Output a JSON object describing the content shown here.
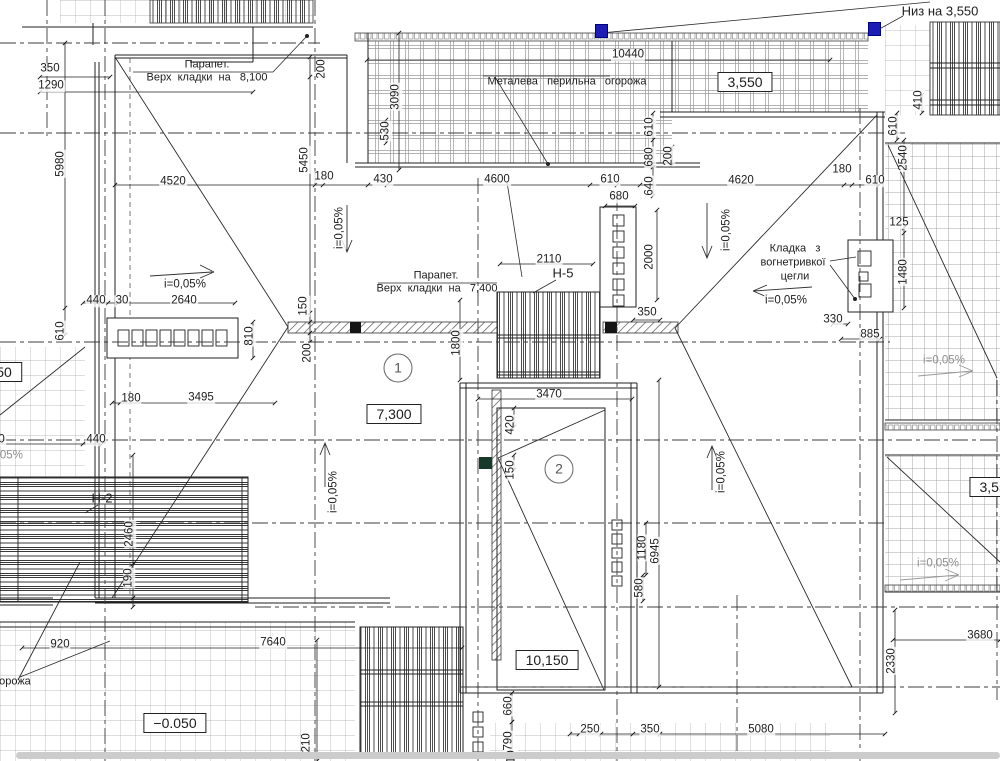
{
  "colors": {
    "paper": "#ffffff",
    "ink": "#1c1c1c",
    "grid": "#a0a0a0",
    "accent_blue": "#1d1db5",
    "muted": "#8f8f8f"
  },
  "plan": {
    "region_markers": [
      "1",
      "2"
    ],
    "node_labels": [
      "Н-5",
      "Н-2"
    ],
    "elevation_boxes": [
      "3,550",
      "7,300",
      "10,150",
      "−0.050",
      "3,550",
      "50"
    ],
    "slope_label": "i=0,05%"
  },
  "annotations": [
    {
      "t": "350",
      "x": 50,
      "y": 69
    },
    {
      "t": "1290",
      "x": 51,
      "y": 86
    },
    {
      "t": "5980",
      "x": 61,
      "y": 164,
      "r": 1
    },
    {
      "t": "200",
      "x": 322,
      "y": 69,
      "r": 1
    },
    {
      "t": "5450",
      "x": 305,
      "y": 160,
      "r": 1
    },
    {
      "t": "4520",
      "x": 173,
      "y": 182
    },
    {
      "t": "180",
      "x": 324,
      "y": 177
    },
    {
      "t": "430",
      "x": 383,
      "y": 180
    },
    {
      "t": "4600",
      "x": 497,
      "y": 180
    },
    {
      "t": "610",
      "x": 610,
      "y": 180
    },
    {
      "t": "4620",
      "x": 741,
      "y": 181
    },
    {
      "t": "180",
      "x": 842,
      "y": 170
    },
    {
      "t": "610",
      "x": 875,
      "y": 181
    },
    {
      "t": "10440",
      "x": 628,
      "y": 55
    },
    {
      "t": "3090",
      "x": 396,
      "y": 97,
      "r": 1
    },
    {
      "t": "530",
      "x": 386,
      "y": 131,
      "r": 1
    },
    {
      "t": "680",
      "x": 619,
      "y": 197
    },
    {
      "t": "610",
      "x": 650,
      "y": 127,
      "r": 1
    },
    {
      "t": "680",
      "x": 650,
      "y": 157,
      "r": 1
    },
    {
      "t": "640",
      "x": 650,
      "y": 186,
      "r": 1
    },
    {
      "t": "200",
      "x": 669,
      "y": 156,
      "r": 1
    },
    {
      "t": "2000",
      "x": 650,
      "y": 257,
      "r": 1
    },
    {
      "t": "410",
      "x": 919,
      "y": 100,
      "r": 1
    },
    {
      "t": "610",
      "x": 894,
      "y": 126,
      "r": 1
    },
    {
      "t": "2540",
      "x": 904,
      "y": 158,
      "r": 1
    },
    {
      "t": "125",
      "x": 899,
      "y": 223
    },
    {
      "t": "1480",
      "x": 904,
      "y": 272,
      "r": 1
    },
    {
      "t": "330",
      "x": 833,
      "y": 320
    },
    {
      "t": "885",
      "x": 870,
      "y": 335
    },
    {
      "t": "350",
      "x": 647,
      "y": 313
    },
    {
      "t": "2110",
      "x": 549,
      "y": 260
    },
    {
      "t": "1800",
      "x": 457,
      "y": 343,
      "r": 1
    },
    {
      "t": "440",
      "x": 96,
      "y": 301
    },
    {
      "t": "30",
      "x": 122,
      "y": 301
    },
    {
      "t": "2640",
      "x": 184,
      "y": 301
    },
    {
      "t": "610",
      "x": 61,
      "y": 331,
      "r": 1
    },
    {
      "t": "810",
      "x": 250,
      "y": 336,
      "r": 1
    },
    {
      "t": "150",
      "x": 304,
      "y": 306,
      "r": 1
    },
    {
      "t": "200",
      "x": 308,
      "y": 353,
      "r": 1
    },
    {
      "t": "180",
      "x": 131,
      "y": 399
    },
    {
      "t": "3495",
      "x": 201,
      "y": 398
    },
    {
      "t": "440",
      "x": 96,
      "y": 440
    },
    {
      "t": "6000",
      "x": -8,
      "y": 440
    },
    {
      "t": "3470",
      "x": 549,
      "y": 395
    },
    {
      "t": "420",
      "x": 511,
      "y": 425,
      "r": 1
    },
    {
      "t": "150",
      "x": 511,
      "y": 470,
      "r": 1
    },
    {
      "t": "2460",
      "x": 130,
      "y": 534,
      "r": 1
    },
    {
      "t": "190",
      "x": 129,
      "y": 578,
      "r": 1
    },
    {
      "t": "1180",
      "x": 643,
      "y": 548,
      "r": 1
    },
    {
      "t": "6945",
      "x": 656,
      "y": 551,
      "r": 1
    },
    {
      "t": "580",
      "x": 640,
      "y": 588,
      "r": 1
    },
    {
      "t": "920",
      "x": 60,
      "y": 645
    },
    {
      "t": "7640",
      "x": 273,
      "y": 643
    },
    {
      "t": "6210",
      "x": 307,
      "y": 746,
      "r": 1
    },
    {
      "t": "660",
      "x": 509,
      "y": 706,
      "r": 1
    },
    {
      "t": "790",
      "x": 509,
      "y": 741,
      "r": 1
    },
    {
      "t": "610",
      "x": 512,
      "y": 760,
      "r": 1
    },
    {
      "t": "250",
      "x": 590,
      "y": 730
    },
    {
      "t": "350",
      "x": 650,
      "y": 730
    },
    {
      "t": "5080",
      "x": 761,
      "y": 730
    },
    {
      "t": "3680",
      "x": 980,
      "y": 636
    },
    {
      "t": "2330",
      "x": 892,
      "y": 661,
      "r": 1
    },
    {
      "t": "i=0,05%",
      "x": 185,
      "y": 285,
      "n": "slope-label"
    },
    {
      "t": "i=0,05%",
      "x": 786,
      "y": 301,
      "n": "slope-label"
    },
    {
      "t": "i=0,05%",
      "x": 340,
      "y": 228,
      "r": 1,
      "n": "slope-label"
    },
    {
      "t": "i=0,05%",
      "x": 727,
      "y": 230,
      "r": 1,
      "n": "slope-label"
    },
    {
      "t": "i=0,05%",
      "x": 334,
      "y": 492,
      "r": 1,
      "n": "slope-label"
    },
    {
      "t": "i=0,05%",
      "x": 722,
      "y": 472,
      "r": 1,
      "n": "slope-label"
    },
    {
      "t": "i=0,05%",
      "x": 944,
      "y": 361,
      "c": "gray",
      "n": "slope-label"
    },
    {
      "t": "i=0,05%",
      "x": 938,
      "y": 564,
      "c": "gray",
      "n": "slope-label"
    },
    {
      "t": "i=0,05%",
      "x": 2,
      "y": 456,
      "c": "gray",
      "n": "slope-label"
    },
    {
      "t": "Парапет.",
      "x": 207,
      "y": 65,
      "c": "note",
      "n": "parapet-note-title"
    },
    {
      "t": "Верх  кладки  на   8,100",
      "x": 207,
      "y": 78,
      "c": "note",
      "n": "parapet-note-body"
    },
    {
      "t": "Парапет.",
      "x": 436,
      "y": 276,
      "c": "note",
      "n": "parapet-note-title"
    },
    {
      "t": "Верх  кладки  на   7,400",
      "x": 437,
      "y": 289,
      "c": "note",
      "n": "parapet-note-body"
    },
    {
      "t": "Металева   перильна   огорожа",
      "x": 567,
      "y": 82,
      "c": "note",
      "n": "railing-note"
    },
    {
      "t": "Кладка   з",
      "x": 795,
      "y": 249,
      "c": "note",
      "n": "masonry-note-line1"
    },
    {
      "t": "вогнетривкої",
      "x": 793,
      "y": 263,
      "c": "note",
      "n": "masonry-note-line2"
    },
    {
      "t": "цегли",
      "x": 795,
      "y": 277,
      "c": "note",
      "n": "masonry-note-line3"
    },
    {
      "t": "Низ на 3,550",
      "x": 940,
      "y": 11,
      "c": "note2",
      "n": "level-note"
    },
    {
      "t": "Ств.С 450",
      "x": 935,
      "y": -5,
      "c": "note2",
      "n": "level-note-partial"
    },
    {
      "t": "огорожа",
      "x": 10,
      "y": 682,
      "c": "note",
      "n": "railing-note-partial"
    },
    {
      "t": "Н-5",
      "x": 563,
      "y": 273,
      "c": "node",
      "n": "node-label-h5"
    },
    {
      "t": "Н-2",
      "x": 102,
      "y": 498,
      "c": "node",
      "n": "node-label-h2"
    },
    {
      "t": "3,550",
      "x": 745,
      "y": 82,
      "c": "box",
      "n": "elevation-box"
    },
    {
      "t": "7,300",
      "x": 394,
      "y": 414,
      "c": "box",
      "n": "elevation-box"
    },
    {
      "t": "10,150",
      "x": 547,
      "y": 660,
      "c": "box",
      "n": "elevation-box"
    },
    {
      "t": "−0.050",
      "x": 175,
      "y": 723,
      "c": "box",
      "n": "elevation-box"
    },
    {
      "t": "3,550",
      "x": 997,
      "y": 487,
      "c": "box",
      "n": "elevation-box"
    },
    {
      "t": "50",
      "x": 4,
      "y": 372,
      "c": "box",
      "n": "elevation-box"
    },
    {
      "t": "1",
      "x": 398,
      "y": 368,
      "c": "circle",
      "n": "region-marker-1"
    },
    {
      "t": "2",
      "x": 559,
      "y": 469,
      "c": "circle",
      "n": "region-marker-2"
    }
  ]
}
